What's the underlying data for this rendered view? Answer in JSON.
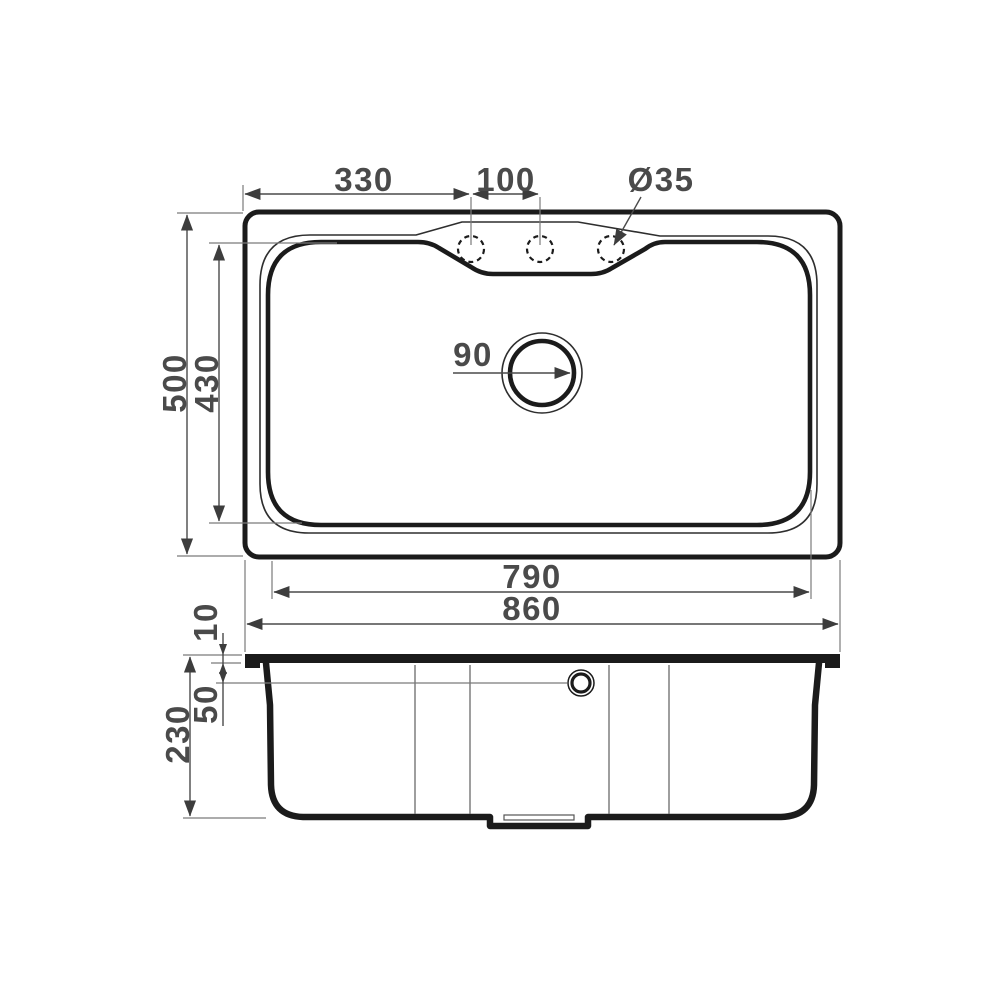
{
  "diagram": {
    "type": "technical-drawing",
    "subject": "kitchen-sink-dimension-drawing",
    "colors": {
      "outline": "#1b1b1b",
      "dimension": "#4a4a4a",
      "extension": "#7a7a7a",
      "background": "#ffffff"
    },
    "top_view": {
      "name": "top view",
      "dims": {
        "faucet_offset": "330",
        "hole_spacing": "100",
        "hole_diameter": "Ø35",
        "overall_depth": "500",
        "bowl_depth": "430",
        "drain_diameter": "90",
        "bowl_width": "790",
        "overall_width": "860"
      },
      "faucet_hole_count": 3
    },
    "side_view": {
      "name": "side section view",
      "dims": {
        "rim_height": "10",
        "overflow_depth": "50",
        "total_height": "230"
      }
    }
  }
}
